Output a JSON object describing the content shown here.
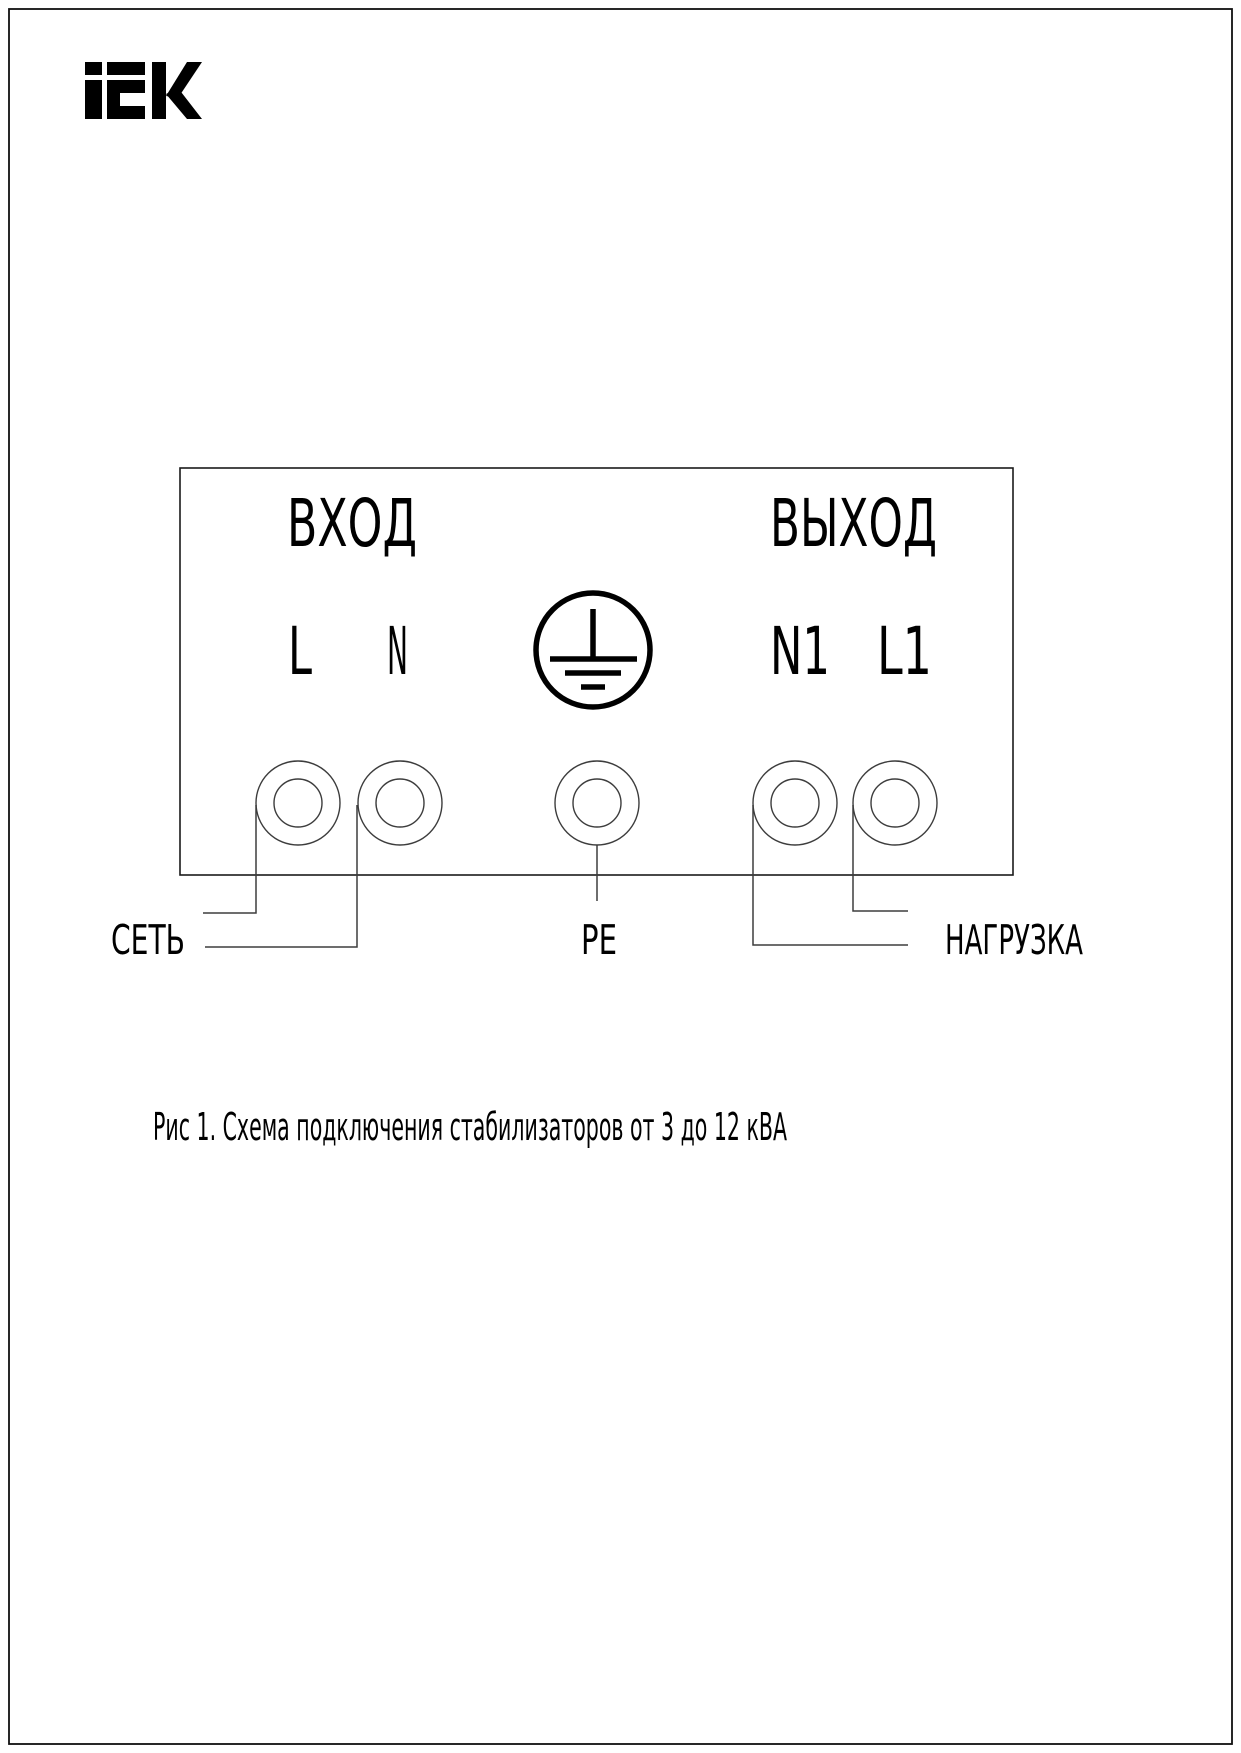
{
  "logo": {
    "brand": "iEK"
  },
  "diagram": {
    "input_label": "ВХОД",
    "output_label": "ВЫХОД",
    "terminals": {
      "l": "L",
      "n": "N",
      "n1": "N1",
      "l1": "L1"
    },
    "ground_icon": "protective-earth-icon",
    "bottom_labels": {
      "mains": "СЕТЬ",
      "pe": "PE",
      "load": "НАГРУЗКА"
    }
  },
  "caption": {
    "text": "Рис 1. Схема подключения стабилизаторов от 3 до 12 кВА"
  },
  "colors": {
    "ink": "#000000",
    "thin_line": "#3d3d3d",
    "paper": "#ffffff"
  }
}
